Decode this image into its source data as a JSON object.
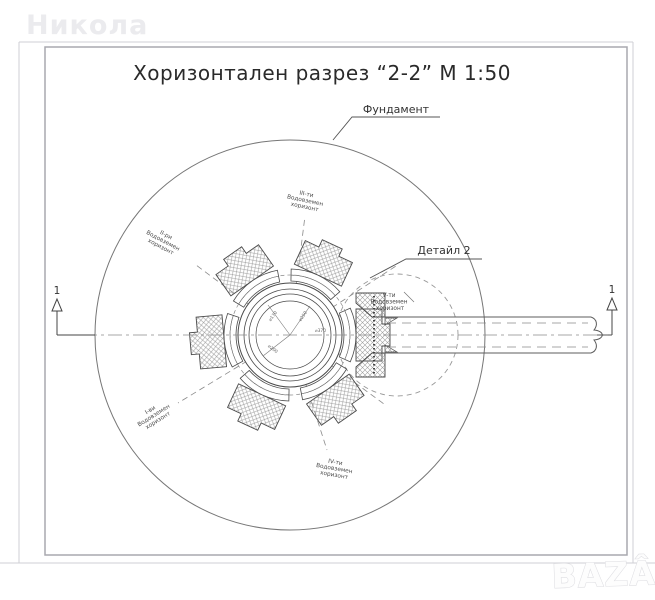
{
  "title": "Хоризонтален разрез “2-2” М 1:50",
  "watermarks": {
    "seller_name": "Никола",
    "marketplace_logo": "BAZÂR"
  },
  "callouts": {
    "foundation": "Фундамент",
    "detail": "Детайл 2"
  },
  "section_markers": {
    "left": "1",
    "right": "1"
  },
  "horizons": [
    {
      "ordinal": "I-ви",
      "line2": "Водовземен",
      "line3": "хоризонт"
    },
    {
      "ordinal": "II-ри",
      "line2": "Водовземен",
      "line3": "хоризонт"
    },
    {
      "ordinal": "III-ти",
      "line2": "Водовземен",
      "line3": "хоризонт"
    },
    {
      "ordinal": "IV-ти",
      "line2": "Водовземен",
      "line3": "хоризонт"
    },
    {
      "ordinal": "V-ти",
      "line2": "Водовземен",
      "line3": "хоризонт"
    }
  ],
  "dimensions": {
    "d1": "⌀170",
    "d2": "⌀200",
    "d3": "⌀250",
    "d4": "⌀370"
  },
  "colors": {
    "line": "#4a4a4a",
    "hatch": "#9d9d9d",
    "dashed": "#8a8a8a",
    "frame": "#a9a9af",
    "outer_frame": "#cfcfd4",
    "watermark": "#ebebee"
  }
}
